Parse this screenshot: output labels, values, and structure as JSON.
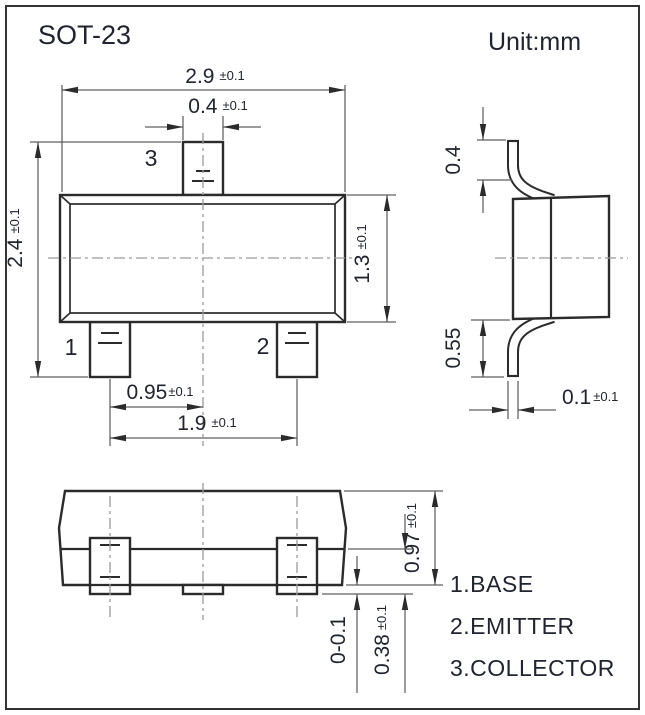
{
  "title": "SOT-23",
  "unit_label": "Unit:mm",
  "pin_labels": {
    "pin1": "1",
    "pin2": "2",
    "pin3": "3"
  },
  "legend": {
    "pin1": "1.BASE",
    "pin2": "2.EMITTER",
    "pin3": "3.COLLECTOR"
  },
  "dimensions": {
    "body_width": {
      "value": "2.9",
      "tolerance": "±0.1"
    },
    "pin3_width": {
      "value": "0.4",
      "tolerance": "±0.1"
    },
    "overall_width": {
      "value": "2.4",
      "tolerance": "±0.1"
    },
    "body_depth": {
      "value": "1.3",
      "tolerance": "±0.1"
    },
    "pin_half_pitch": {
      "value": "0.95",
      "tolerance": "±0.1"
    },
    "pin_pitch": {
      "value": "1.9",
      "tolerance": "±0.1"
    },
    "lead_top_height": {
      "value": "0.4",
      "tolerance": ""
    },
    "lead_bottom_height": {
      "value": "0.55",
      "tolerance": ""
    },
    "lead_thickness": {
      "value": "0.1",
      "tolerance": "±0.1"
    },
    "overall_height": {
      "value": "0.97",
      "tolerance": "±0.1"
    },
    "lead_foot_height": {
      "value": "0.38",
      "tolerance": "±0.1"
    },
    "standoff": {
      "value": "0-0.1",
      "tolerance": ""
    }
  },
  "colors": {
    "line": "#2b2b2b",
    "thin": "#5f5f5f",
    "center": "#9a9a9a",
    "text": "#20242e",
    "bg": "#ffffff"
  }
}
